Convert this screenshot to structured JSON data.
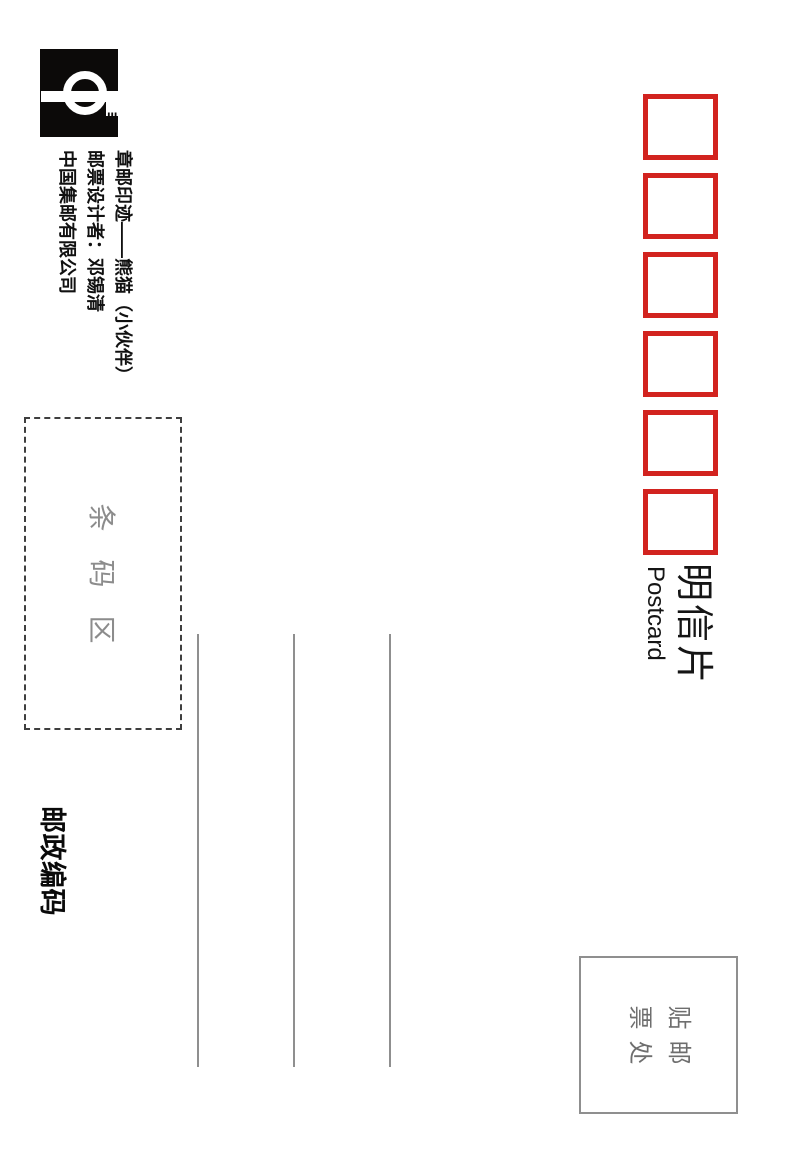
{
  "title": {
    "cn": "明信片",
    "en": "Postcard"
  },
  "postal_code_boxes": {
    "count": 6
  },
  "stamp_area": {
    "line1": "贴邮",
    "line2": "票处"
  },
  "barcode_area": {
    "label": "条码区"
  },
  "postal_code_label": "邮政编码",
  "credits": {
    "series": "章邮印迹——熊猫（小伙伴）",
    "designer": "邮票设计者：邓锡清",
    "company": "中国集邮有限公司"
  },
  "logo": {
    "name": "china-philately-logo"
  },
  "colors": {
    "box_red": "#d2231f",
    "ink_black": "#151515",
    "line_gray": "#8f8f8f",
    "label_gray": "#6e6e6e"
  }
}
